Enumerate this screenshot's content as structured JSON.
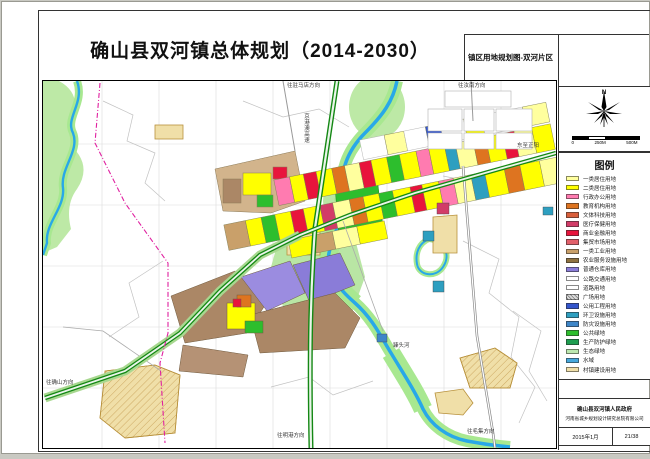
{
  "header": {
    "title": "确山县双河镇总体规划（2014-2030）",
    "subtitle": "镇区用地规划图-双河片区"
  },
  "compass": {
    "north_label": "N",
    "scale_ticks": [
      "0",
      "250M",
      "500M"
    ]
  },
  "legend": {
    "title": "图例",
    "items": [
      {
        "label": "一类居住用地",
        "color": "#FFFF9E"
      },
      {
        "label": "二类居住用地",
        "color": "#FFFF00"
      },
      {
        "label": "行政办公用地",
        "color": "#FF7BB0"
      },
      {
        "label": "教育机构用地",
        "color": "#DE7420"
      },
      {
        "label": "文体科技用地",
        "color": "#D95F3B"
      },
      {
        "label": "医疗保健用地",
        "color": "#D23C68"
      },
      {
        "label": "商业金融用地",
        "color": "#E8143C"
      },
      {
        "label": "集贸市场用地",
        "color": "#E2606A"
      },
      {
        "label": "一类工业用地",
        "color": "#C9A06A"
      },
      {
        "label": "农业服务设施用地",
        "color": "#8F7240"
      },
      {
        "label": "普通仓库用地",
        "color": "#8A7CD8"
      },
      {
        "label": "公路交通用地",
        "color": "#FFFFFF"
      },
      {
        "label": "道路用地",
        "color": "#FFFFFF"
      },
      {
        "label": "广场用地",
        "color": "#D9D9D9",
        "pattern": "hatch"
      },
      {
        "label": "公用工程用地",
        "color": "#3355CC"
      },
      {
        "label": "环卫设施用地",
        "color": "#2E9FC0"
      },
      {
        "label": "防灾设施用地",
        "color": "#3E86C8"
      },
      {
        "label": "公共绿地",
        "color": "#2DBE2D"
      },
      {
        "label": "生产防护绿地",
        "color": "#1E9E50"
      },
      {
        "label": "生态绿地",
        "color": "#BCE8B0"
      },
      {
        "label": "水域",
        "color": "#46A8DC"
      },
      {
        "label": "村镇建设用地",
        "color": "#F0DFA8"
      }
    ]
  },
  "title_block": {
    "line1": "确山县双河镇人民政府",
    "line2": "河南省城乡规划设计研究总院有限公司",
    "date": "2015年1月",
    "page": "21/38"
  },
  "map": {
    "labels": [
      {
        "text": "往驻马店方向",
        "x": 244,
        "y": 2,
        "vertical": false
      },
      {
        "text": "京港澳高速",
        "x": 260,
        "y": 32,
        "vertical": true
      },
      {
        "text": "往汝南方向",
        "x": 415,
        "y": 2,
        "vertical": false
      },
      {
        "text": "东至正阳",
        "x": 474,
        "y": 62,
        "vertical": false
      },
      {
        "text": "臻头河",
        "x": 350,
        "y": 262,
        "vertical": false
      },
      {
        "text": "往确山方向",
        "x": 3,
        "y": 299,
        "vertical": false
      },
      {
        "text": "往明港方向",
        "x": 234,
        "y": 352,
        "vertical": false
      },
      {
        "text": "往毛集方向",
        "x": 424,
        "y": 348,
        "vertical": false
      }
    ]
  }
}
